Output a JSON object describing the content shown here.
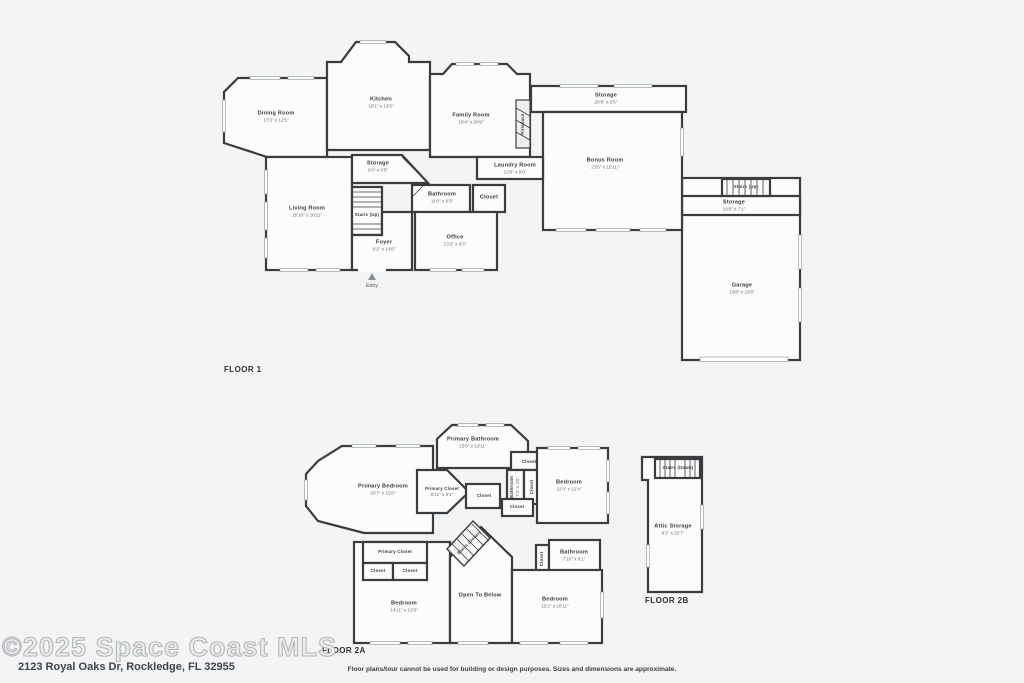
{
  "meta": {
    "watermark": "©2025 Space Coast MLS",
    "address": "2123 Royal Oaks Dr, Rockledge, FL 32955",
    "disclaimer": "Floor plans/tour cannot be used for building or design purposes. Sizes and dimensions are approximate."
  },
  "colors": {
    "wall": "#3a3d40",
    "floor": "#fcfcfc",
    "background": "#f3f4f5",
    "window": "#9aa0a4"
  },
  "floor1": {
    "title": "FLOOR 1",
    "entry_label": "Entry",
    "rooms": {
      "dining": {
        "name": "Dining Room",
        "dims": "17'3\" x 12'5\""
      },
      "kitchen": {
        "name": "Kitchen",
        "dims": "18'1\" x 19'5\""
      },
      "family": {
        "name": "Family Room",
        "dims": "19'4\" x 20'9\""
      },
      "fireplace": {
        "name": "Fireplace"
      },
      "storage_top": {
        "name": "Storage",
        "dims": "20'8\" x 5'5\""
      },
      "bonus": {
        "name": "Bonus Room",
        "dims": "23'5\" x 15'11\""
      },
      "laundry": {
        "name": "Laundry Room",
        "dims": "12'8\" x 9'0\""
      },
      "storage_mid": {
        "name": "Storage",
        "dims": "9'3\" x 6'5\""
      },
      "living": {
        "name": "Living Room",
        "dims": "15'10\" x 18'11\""
      },
      "stairs_main": {
        "name": "Stairs (Up)"
      },
      "bathroom": {
        "name": "Bathroom",
        "dims": "11'0\" x 9'3\""
      },
      "closet": {
        "name": "Closet"
      },
      "office": {
        "name": "Office",
        "dims": "13'2\" x 9'3\""
      },
      "foyer": {
        "name": "Foyer",
        "dims": "9'2\" x 14'6\""
      },
      "stairs_garage": {
        "name": "Stairs (Up)"
      },
      "storage_garage": {
        "name": "Storage",
        "dims": "19'8\" x 7'1\""
      },
      "garage": {
        "name": "Garage",
        "dims": "19'8\" x 23'8\""
      }
    }
  },
  "floor2a": {
    "title": "FLOOR 2A",
    "rooms": {
      "primary_bathroom": {
        "name": "Primary Bathroom",
        "dims": "15'0\" x 13'11\""
      },
      "primary_bedroom": {
        "name": "Primary Bedroom",
        "dims": "20'7\" x 15'6\""
      },
      "primary_closet": {
        "name": "Primary Closet",
        "dims": "8'11\" x 8'1\""
      },
      "closet_top": {
        "name": "Closet"
      },
      "bathroom_small": {
        "name": "Bathroom",
        "dims": "7'4\" x 4'5\""
      },
      "closet_vert": {
        "name": "Closet"
      },
      "closet_center": {
        "name": "Closet"
      },
      "closet_mid": {
        "name": "Closet"
      },
      "bedroom_right": {
        "name": "Bedroom",
        "dims": "11'0\" x 12'4\""
      },
      "primary_closet2": {
        "name": "Primary Closet"
      },
      "closet_a": {
        "name": "Closet"
      },
      "closet_b": {
        "name": "Closet"
      },
      "bedroom_left": {
        "name": "Bedroom",
        "dims": "14'11\" x 12'3\""
      },
      "stairs": {
        "name": "Stairs (Down)"
      },
      "open_below": {
        "name": "Open To Below"
      },
      "closet_bath": {
        "name": "Closet"
      },
      "bathroom2": {
        "name": "Bathroom",
        "dims": "7'10\" x 8'1\""
      },
      "bedroom_bottom": {
        "name": "Bedroom",
        "dims": "15'2\" x 16'11\""
      }
    }
  },
  "floor2b": {
    "title": "FLOOR 2B",
    "rooms": {
      "stairs": {
        "name": "Stairs (Down)"
      },
      "attic": {
        "name": "Attic Storage",
        "dims": "9'2\" x 22'7\""
      }
    }
  }
}
